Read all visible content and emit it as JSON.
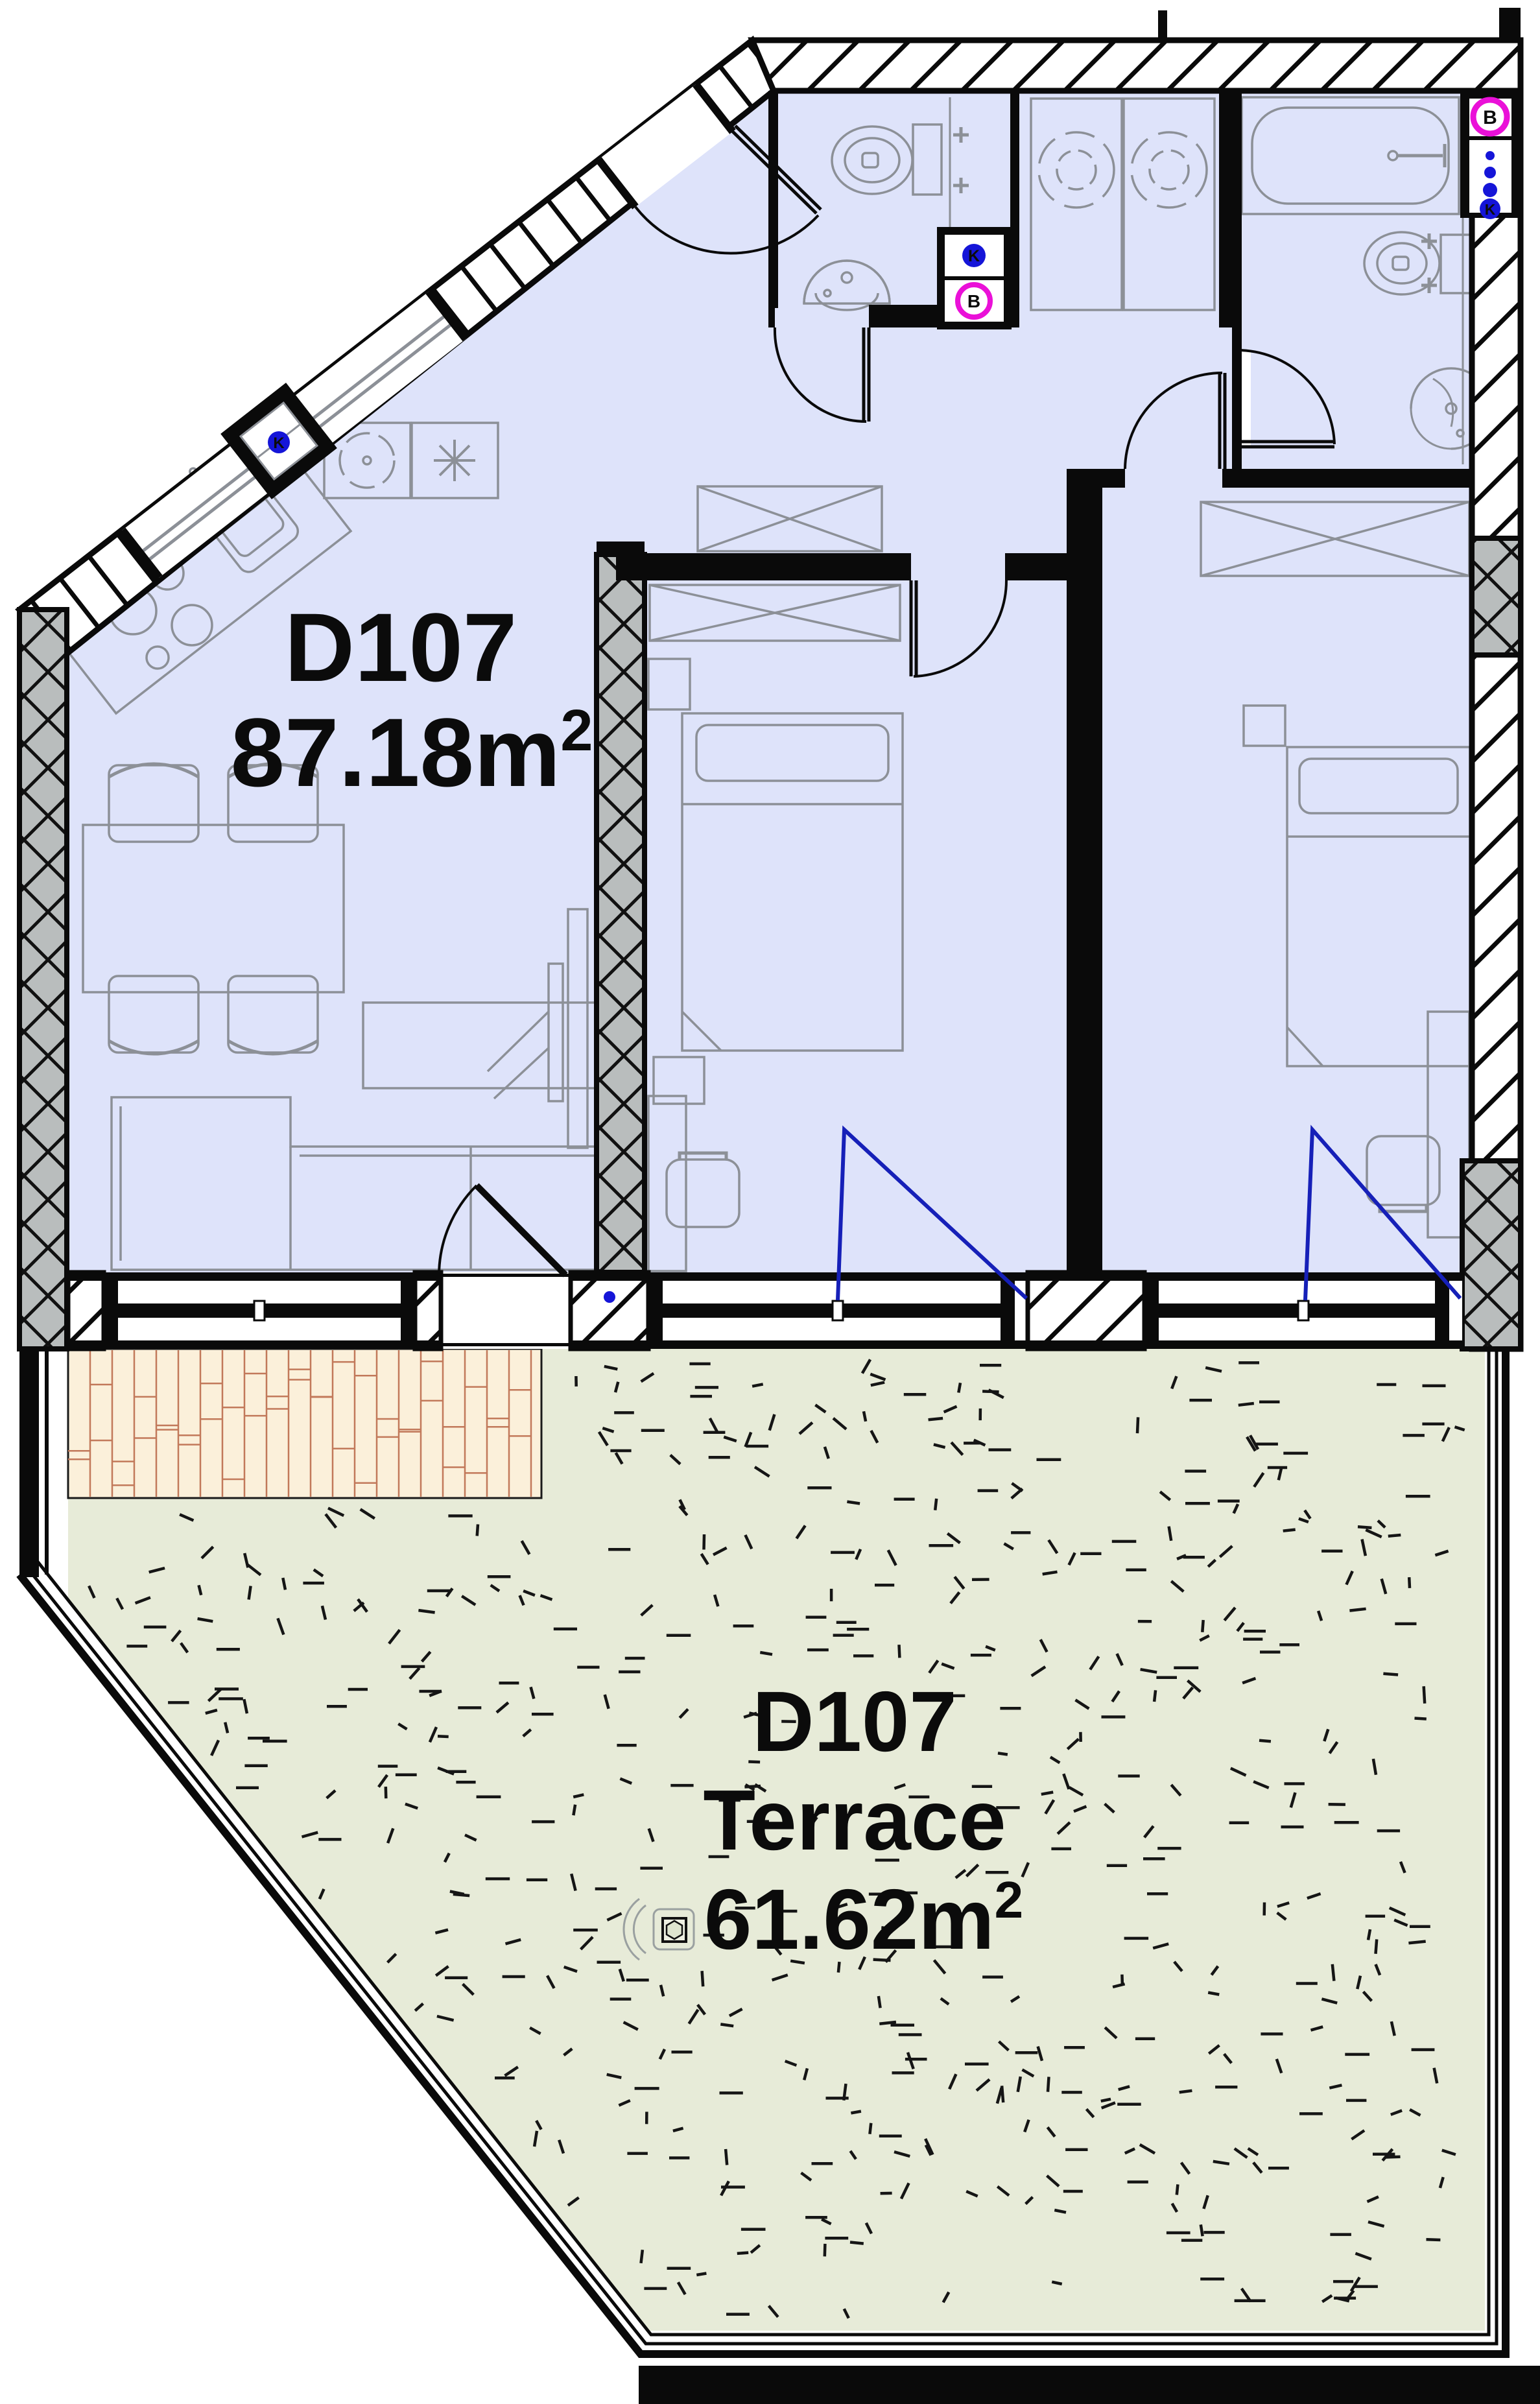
{
  "unit_label": {
    "id": "D107",
    "area": "87.18m",
    "area_sup": "2"
  },
  "terrace_label": {
    "id": "D107",
    "name": "Terrace",
    "area": "61.62m",
    "area_sup": "2"
  },
  "shaft_icons": {
    "kitchen_k": "K",
    "bath1_k": "K",
    "bath1_b": "B",
    "bath2_b": "B",
    "bath2_k": "K"
  },
  "colors": {
    "room_fill": "#dee3fa",
    "terrace_fill": "#e7ebd8",
    "deck_fill": "#fbf0da",
    "deck_line": "#c2795a",
    "wall_black": "#0a0a0a",
    "insulated_gray": "#b9bdbd",
    "furniture_gray": "#8c9097",
    "accent_blue": "#1515d8",
    "accent_magenta": "#ea10d8"
  }
}
